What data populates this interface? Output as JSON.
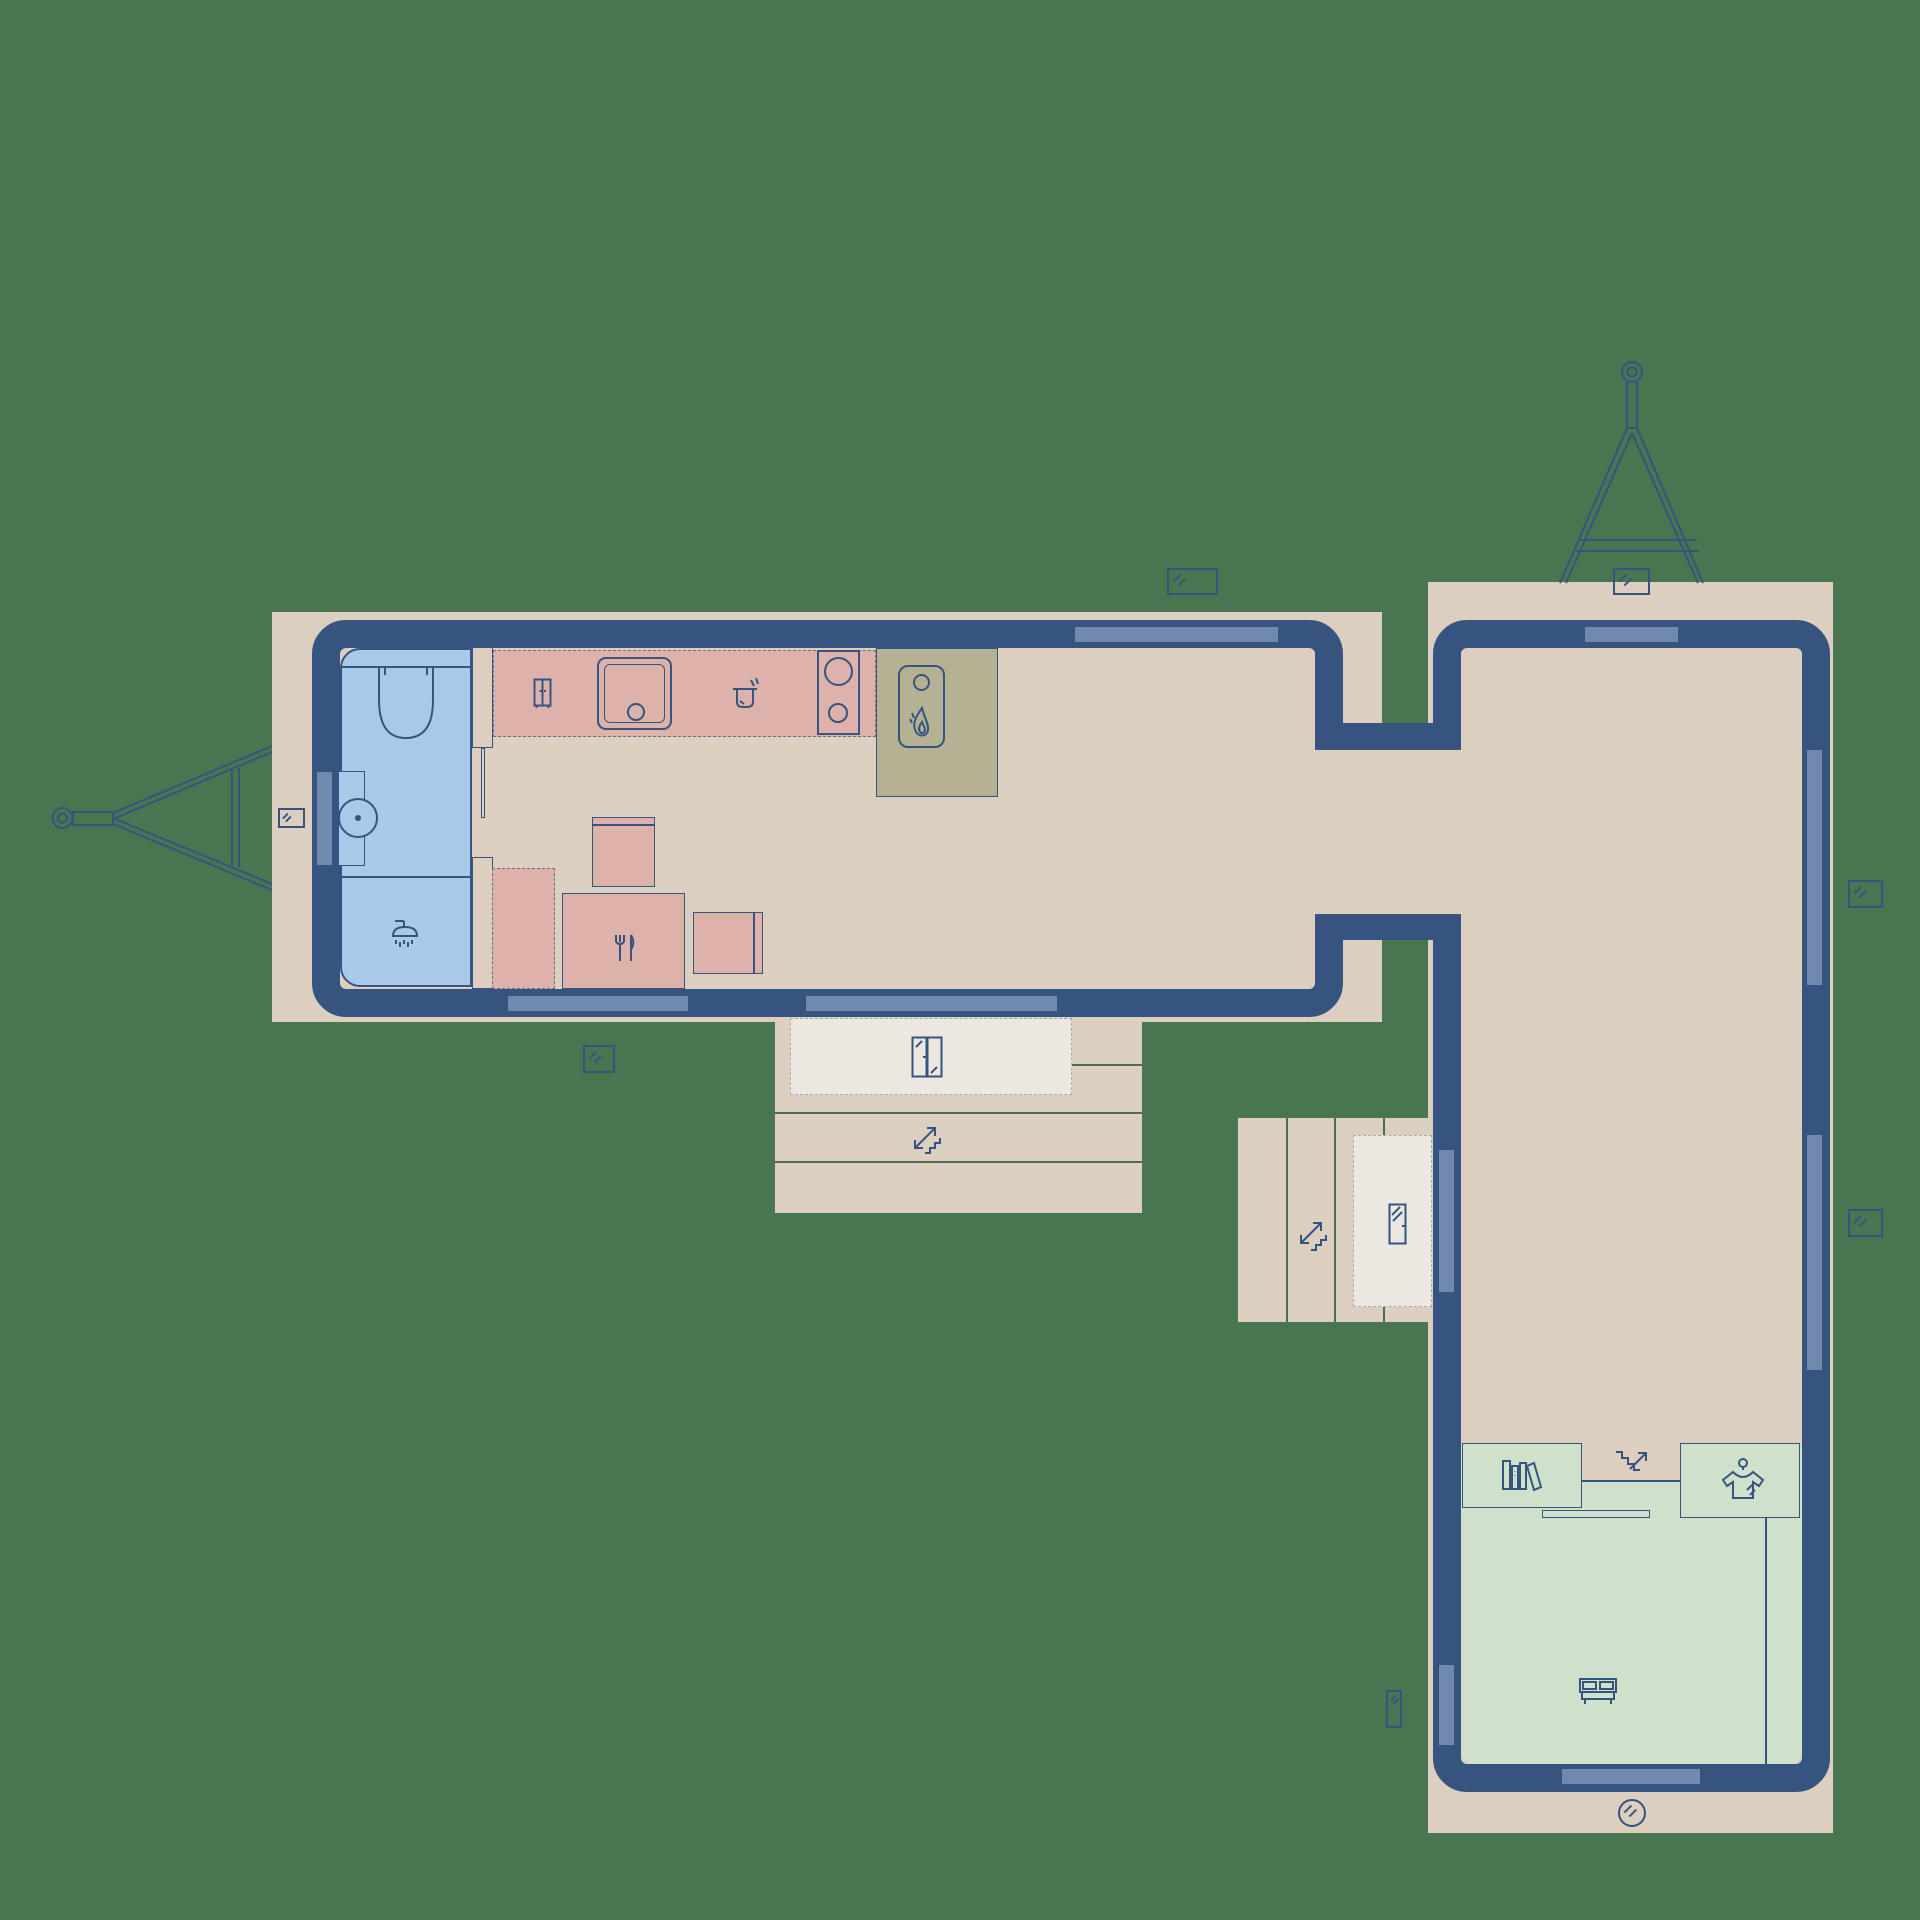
{
  "document": {
    "title": "Tiny house floor plan",
    "type": "architectural floor plan",
    "description": "Top-down plan of an L-shaped tiny home made of two trailer units joined by a short corridor, drawn on a green lawn background"
  },
  "colors": {
    "bg": "#497551",
    "deck": "#dccfc0",
    "wall": "#36547f",
    "window": "#7189ac",
    "bathroom": "#a9c9e9",
    "kitchen": "#dcb2ab",
    "heater": "#b5b294",
    "bedroom": "#cfe0cb",
    "mat": "#ece8e0"
  },
  "units": {
    "main_trailer": {
      "label": "kitchen and bathroom trailer",
      "orientation": "horizontal",
      "hitch_side": "left",
      "rooms": [
        {
          "name": "bathroom",
          "fixtures": [
            "toilet",
            "washbasin",
            "shower"
          ]
        },
        {
          "name": "kitchen",
          "fixtures": [
            "cabinet",
            "kitchen-sink",
            "cooking-pot",
            "two-burner-stove",
            "wood-stove-heater"
          ]
        },
        {
          "name": "dining",
          "fixtures": [
            "cupboard",
            "chair",
            "dining-table",
            "chair"
          ]
        }
      ],
      "windows": {
        "top": 1,
        "bottom": 2,
        "left": 1
      },
      "porch": {
        "steps": 3,
        "mat": true,
        "door": "double-glass-door"
      }
    },
    "corridor": {
      "label": "connecting corridor between the two trailers"
    },
    "bedroom_trailer": {
      "label": "bedroom trailer",
      "orientation": "vertical",
      "hitch_side": "top",
      "rooms": [
        {
          "name": "open-living-space",
          "fixtures": []
        },
        {
          "name": "sleeping-area",
          "fixtures": [
            "bookshelf",
            "loft-stairs",
            "wardrobe",
            "sliding-rail",
            "double-bed"
          ]
        }
      ],
      "windows": {
        "top": 1,
        "left": 2,
        "right": 2,
        "bottom": 1,
        "porthole": 1
      },
      "porch": {
        "steps": 4,
        "mat": true,
        "door": "single-glass-door"
      }
    }
  },
  "icons": [
    "toilet-icon",
    "washbasin-icon",
    "shower-icon",
    "cabinet-icon",
    "pot-icon",
    "burner-icon",
    "flame-icon",
    "fork-knife-icon",
    "stairs-icon",
    "books-icon",
    "shirt-hanger-icon",
    "bed-icon",
    "window-marker-icon",
    "porthole-icon",
    "trailer-hitch-icon",
    "door-icon"
  ],
  "symbols": {
    "window_markers": 7,
    "porthole_markers": 1,
    "stairs_markers": 3,
    "hitches": 2
  }
}
